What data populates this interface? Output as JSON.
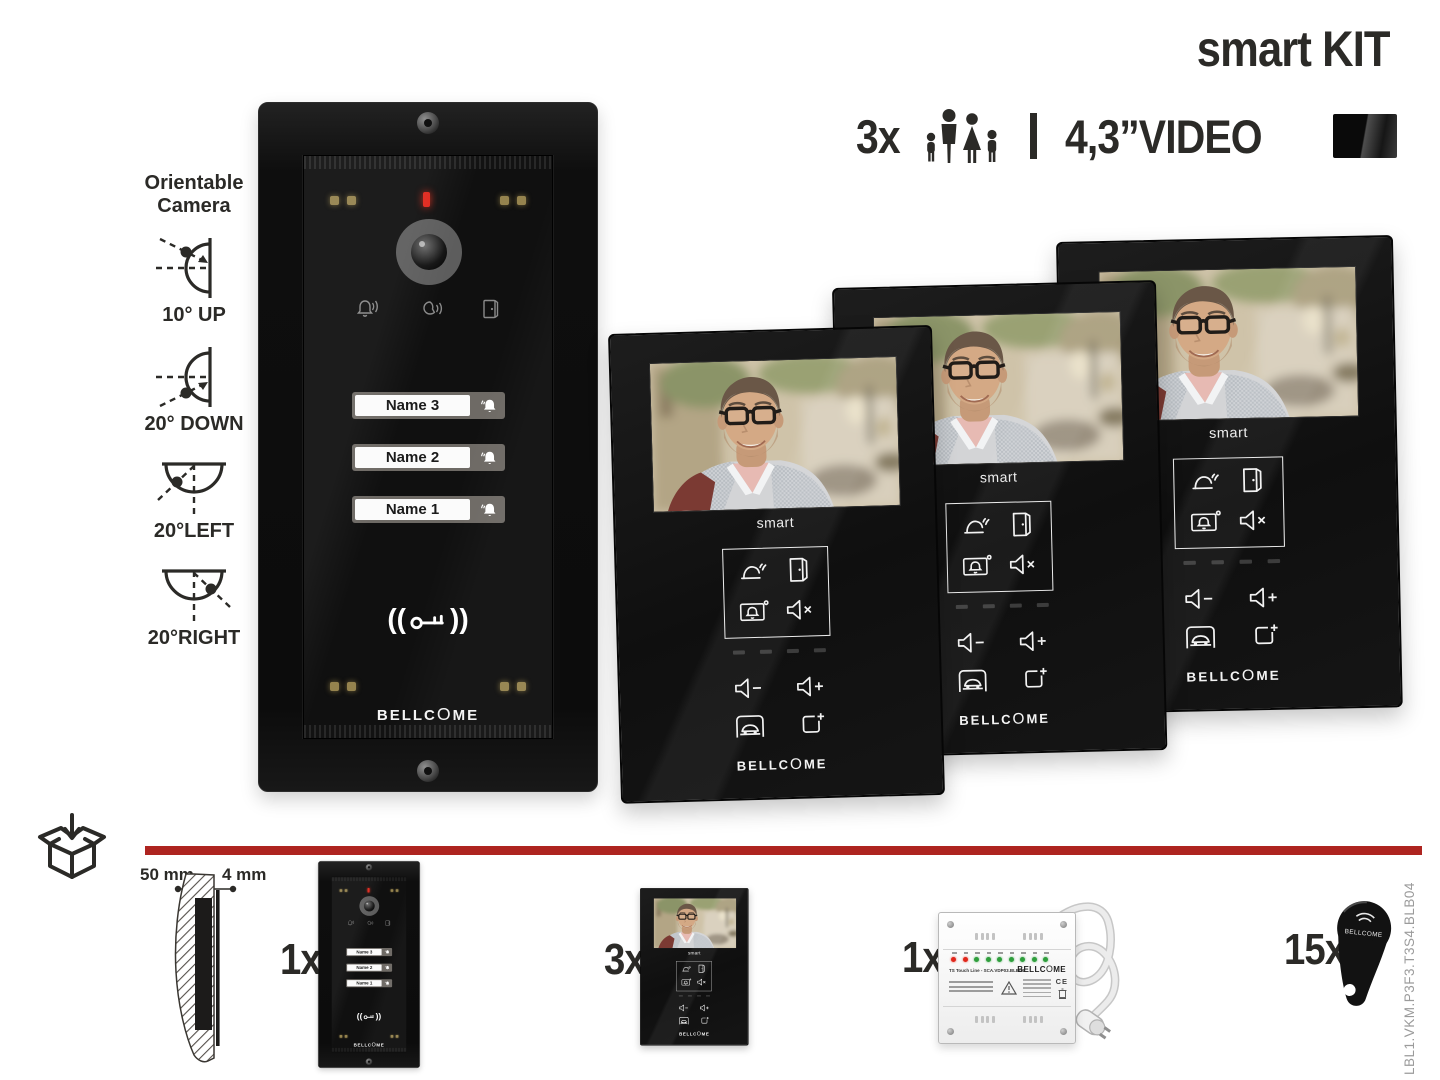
{
  "brand": {
    "prefix": "BELLC",
    "o": "O",
    "suffix": "ME",
    "full": "BELLCOME"
  },
  "header": {
    "title": "smart KIT",
    "monitors_qty": "3x",
    "video_size": "4,3”VIDEO"
  },
  "camera_orientation": {
    "heading_line1": "Orientable",
    "heading_line2": "Camera",
    "items": [
      {
        "label": "10° UP"
      },
      {
        "label": "20° DOWN"
      },
      {
        "label": "20°LEFT"
      },
      {
        "label": "20°RIGHT"
      }
    ]
  },
  "door_panel": {
    "names": [
      "Name 3",
      "Name 2",
      "Name 1"
    ]
  },
  "monitor": {
    "model_label": "smart"
  },
  "package": {
    "wall_depth_label": "50 mm",
    "plate_depth_label": "4 mm",
    "items": [
      {
        "qty": "1x",
        "item": "outdoor-door-panel"
      },
      {
        "qty": "3x",
        "item": "indoor-video-monitor"
      },
      {
        "qty": "1x",
        "item": "power-supply-unit"
      },
      {
        "qty": "15x",
        "item": "rfid-key-fob"
      }
    ]
  },
  "power_supply": {
    "label": "TS Touch Line - SCA.VDP03.BLB04",
    "ce_mark": "CE"
  },
  "side_code": "LBL1.VKM.P3F3.T3S4.BLB04",
  "colors": {
    "accent_red": "#ae2420",
    "led_red": "#e0261b",
    "led_green": "#2f9e3c",
    "led_amber": "#95834e",
    "ink": "#2b2a27"
  }
}
